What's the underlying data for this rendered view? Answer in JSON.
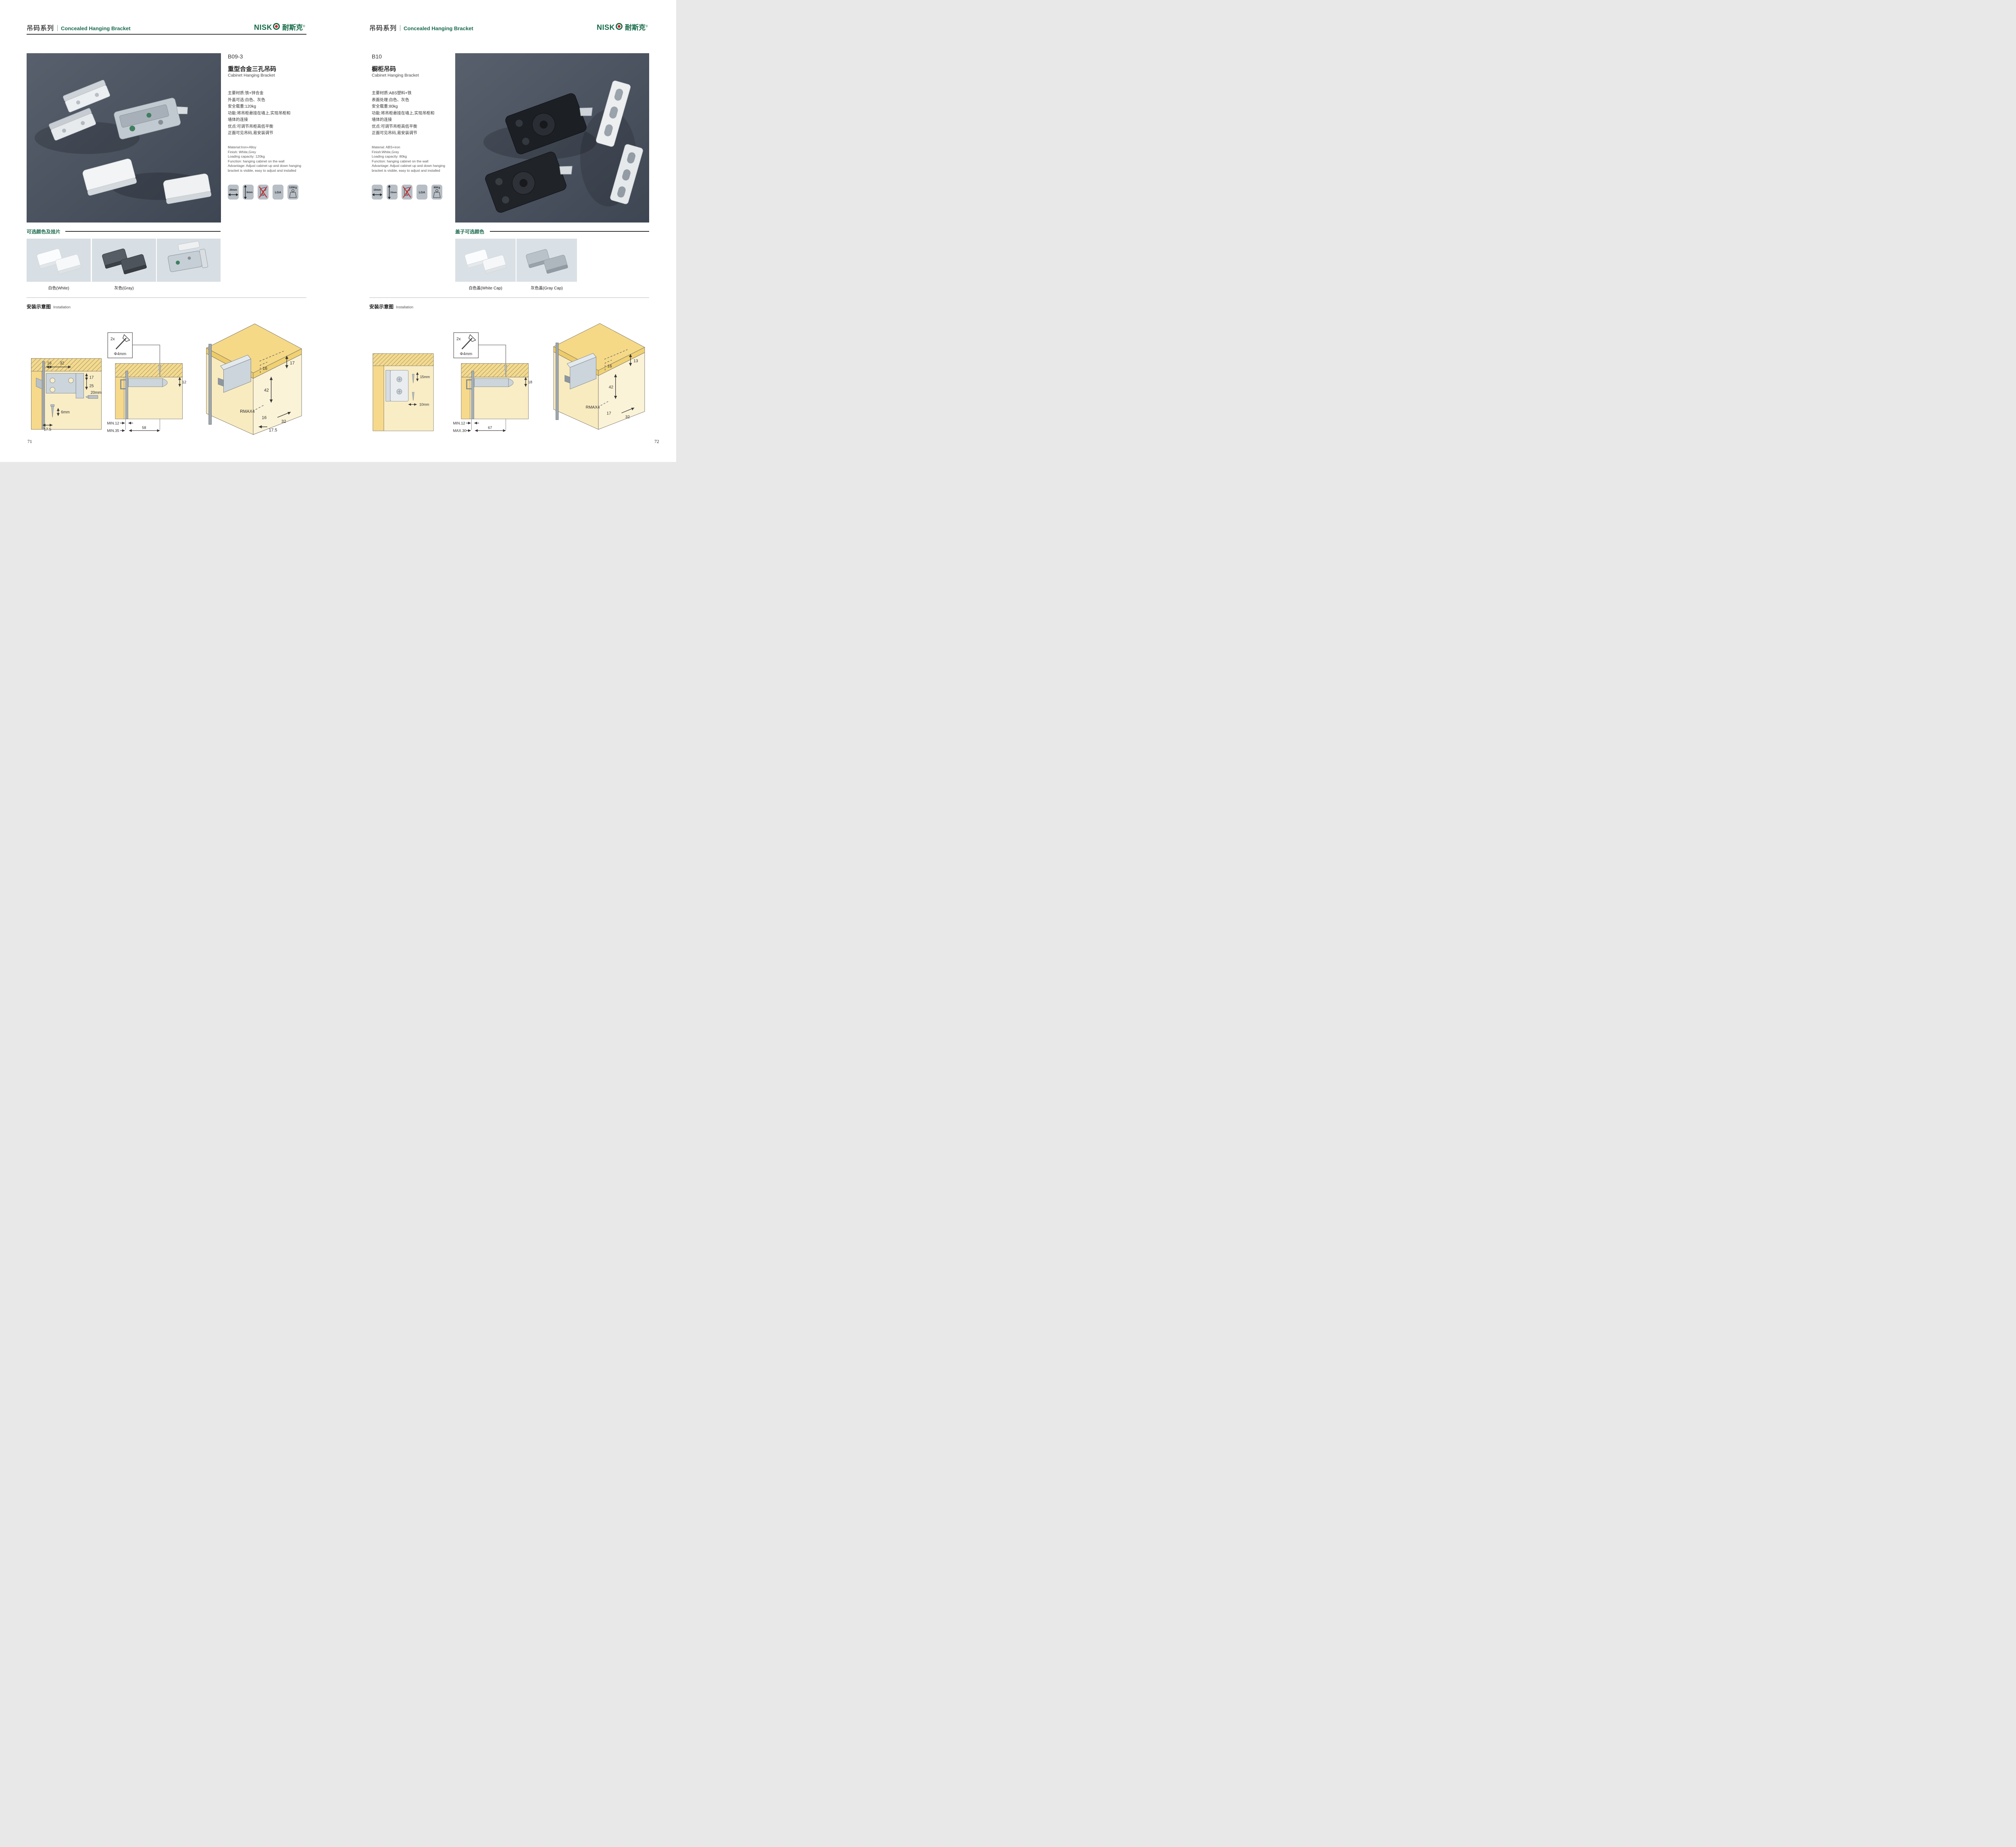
{
  "brand": {
    "latin": "NISK",
    "cn": "耐斯克",
    "reg": "®"
  },
  "left": {
    "header_cn": "吊码系列",
    "header_en": "Concealed Hanging Bracket",
    "code": "B09-3",
    "name_cn": "重型合金三孔吊码",
    "name_en": "Cabinet Hanging Bracket",
    "specs_cn": [
      "主要材质:铁+锌合金",
      "外盖可选:白色、灰色",
      "安全载重:120kg",
      "功能:将吊柜悬挂在墙上,实现吊柜和",
      "墙体的连接",
      "优点:可调节吊柜高低平衡",
      "正面可见吊码,易安装调节"
    ],
    "specs_en": [
      "Material:Iron+Alloy",
      "Finish: White,Grey",
      "Loading capacity: 120kg",
      "Function: hanging cabinet on the wall",
      "Advantage: Adjust cabinet up and down hanging",
      "bracket is visible, easy to adjust and installed"
    ],
    "icon_width": "20mm",
    "icon_height": "6mm",
    "icon_cert": "LGA",
    "icon_load": "120Kg",
    "colors_title": "可选颜色及挂片",
    "swatch_labels": [
      "白色(White)",
      "灰色(Gray)"
    ],
    "install_cn": "安装示意图",
    "install_en": "Installation",
    "diagA": {
      "t1": "16",
      "t2": "32",
      "s1": "17",
      "s2": "25",
      "bit": "20mm",
      "screw": "6mm",
      "b1": "17.5"
    },
    "diagB": {
      "qty": "2x",
      "dia": "Φ4mm",
      "side": "12",
      "r1": "MIN.12",
      "r2": "MIN.35",
      "r3": "58"
    },
    "diagC": {
      "top": "16",
      "side": "17",
      "vert": "42",
      "radius": "RMAX4",
      "b1": "16",
      "b2": "32",
      "b3": "17.5"
    },
    "page_no": "71"
  },
  "right": {
    "header_cn": "吊码系列",
    "header_en": "Concealed Hanging Bracket",
    "code": "B10",
    "name_cn": "橱柜吊码",
    "name_en": "Cabinet Hanging Bracket",
    "specs_cn": [
      "主要材质:ABS塑料+铁",
      "表面处理:白色、灰色",
      "安全载重:80kg",
      "功能:将吊柜悬挂在墙上,实现吊柜和",
      "墙体的连接",
      "优点:可调节吊柜高低平衡",
      "正面可见吊码,易安装调节"
    ],
    "specs_en": [
      "Material: ABS+iron",
      "Finish:White,Grey",
      "Loading capacity: 80kg",
      "Function: hanging cabinet on the wall",
      "Advantage: Adjust cabinet up and down hanging",
      "bracket is visible, easy to adjust and installed"
    ],
    "icon_width": "10mm",
    "icon_height": "15mm",
    "icon_cert": "LGA",
    "icon_load": "80Kg",
    "colors_title": "盖子可选颜色",
    "swatch_labels": [
      "白色盖(White Cap)",
      "灰色盖(Gray Cap)"
    ],
    "install_cn": "安装示意图",
    "install_en": "Installation",
    "diagA": {
      "s1": "15mm",
      "s2": "10mm"
    },
    "diagB": {
      "qty": "2x",
      "dia": "Φ4mm",
      "side": "18",
      "r1": "MIN.12",
      "r2": "MAX.30",
      "r3": "67"
    },
    "diagC": {
      "top": "16",
      "side": "13",
      "vert": "42",
      "radius": "RMAX4",
      "b1": "17",
      "b2": "32",
      "b3": ""
    },
    "page_no": "72"
  }
}
